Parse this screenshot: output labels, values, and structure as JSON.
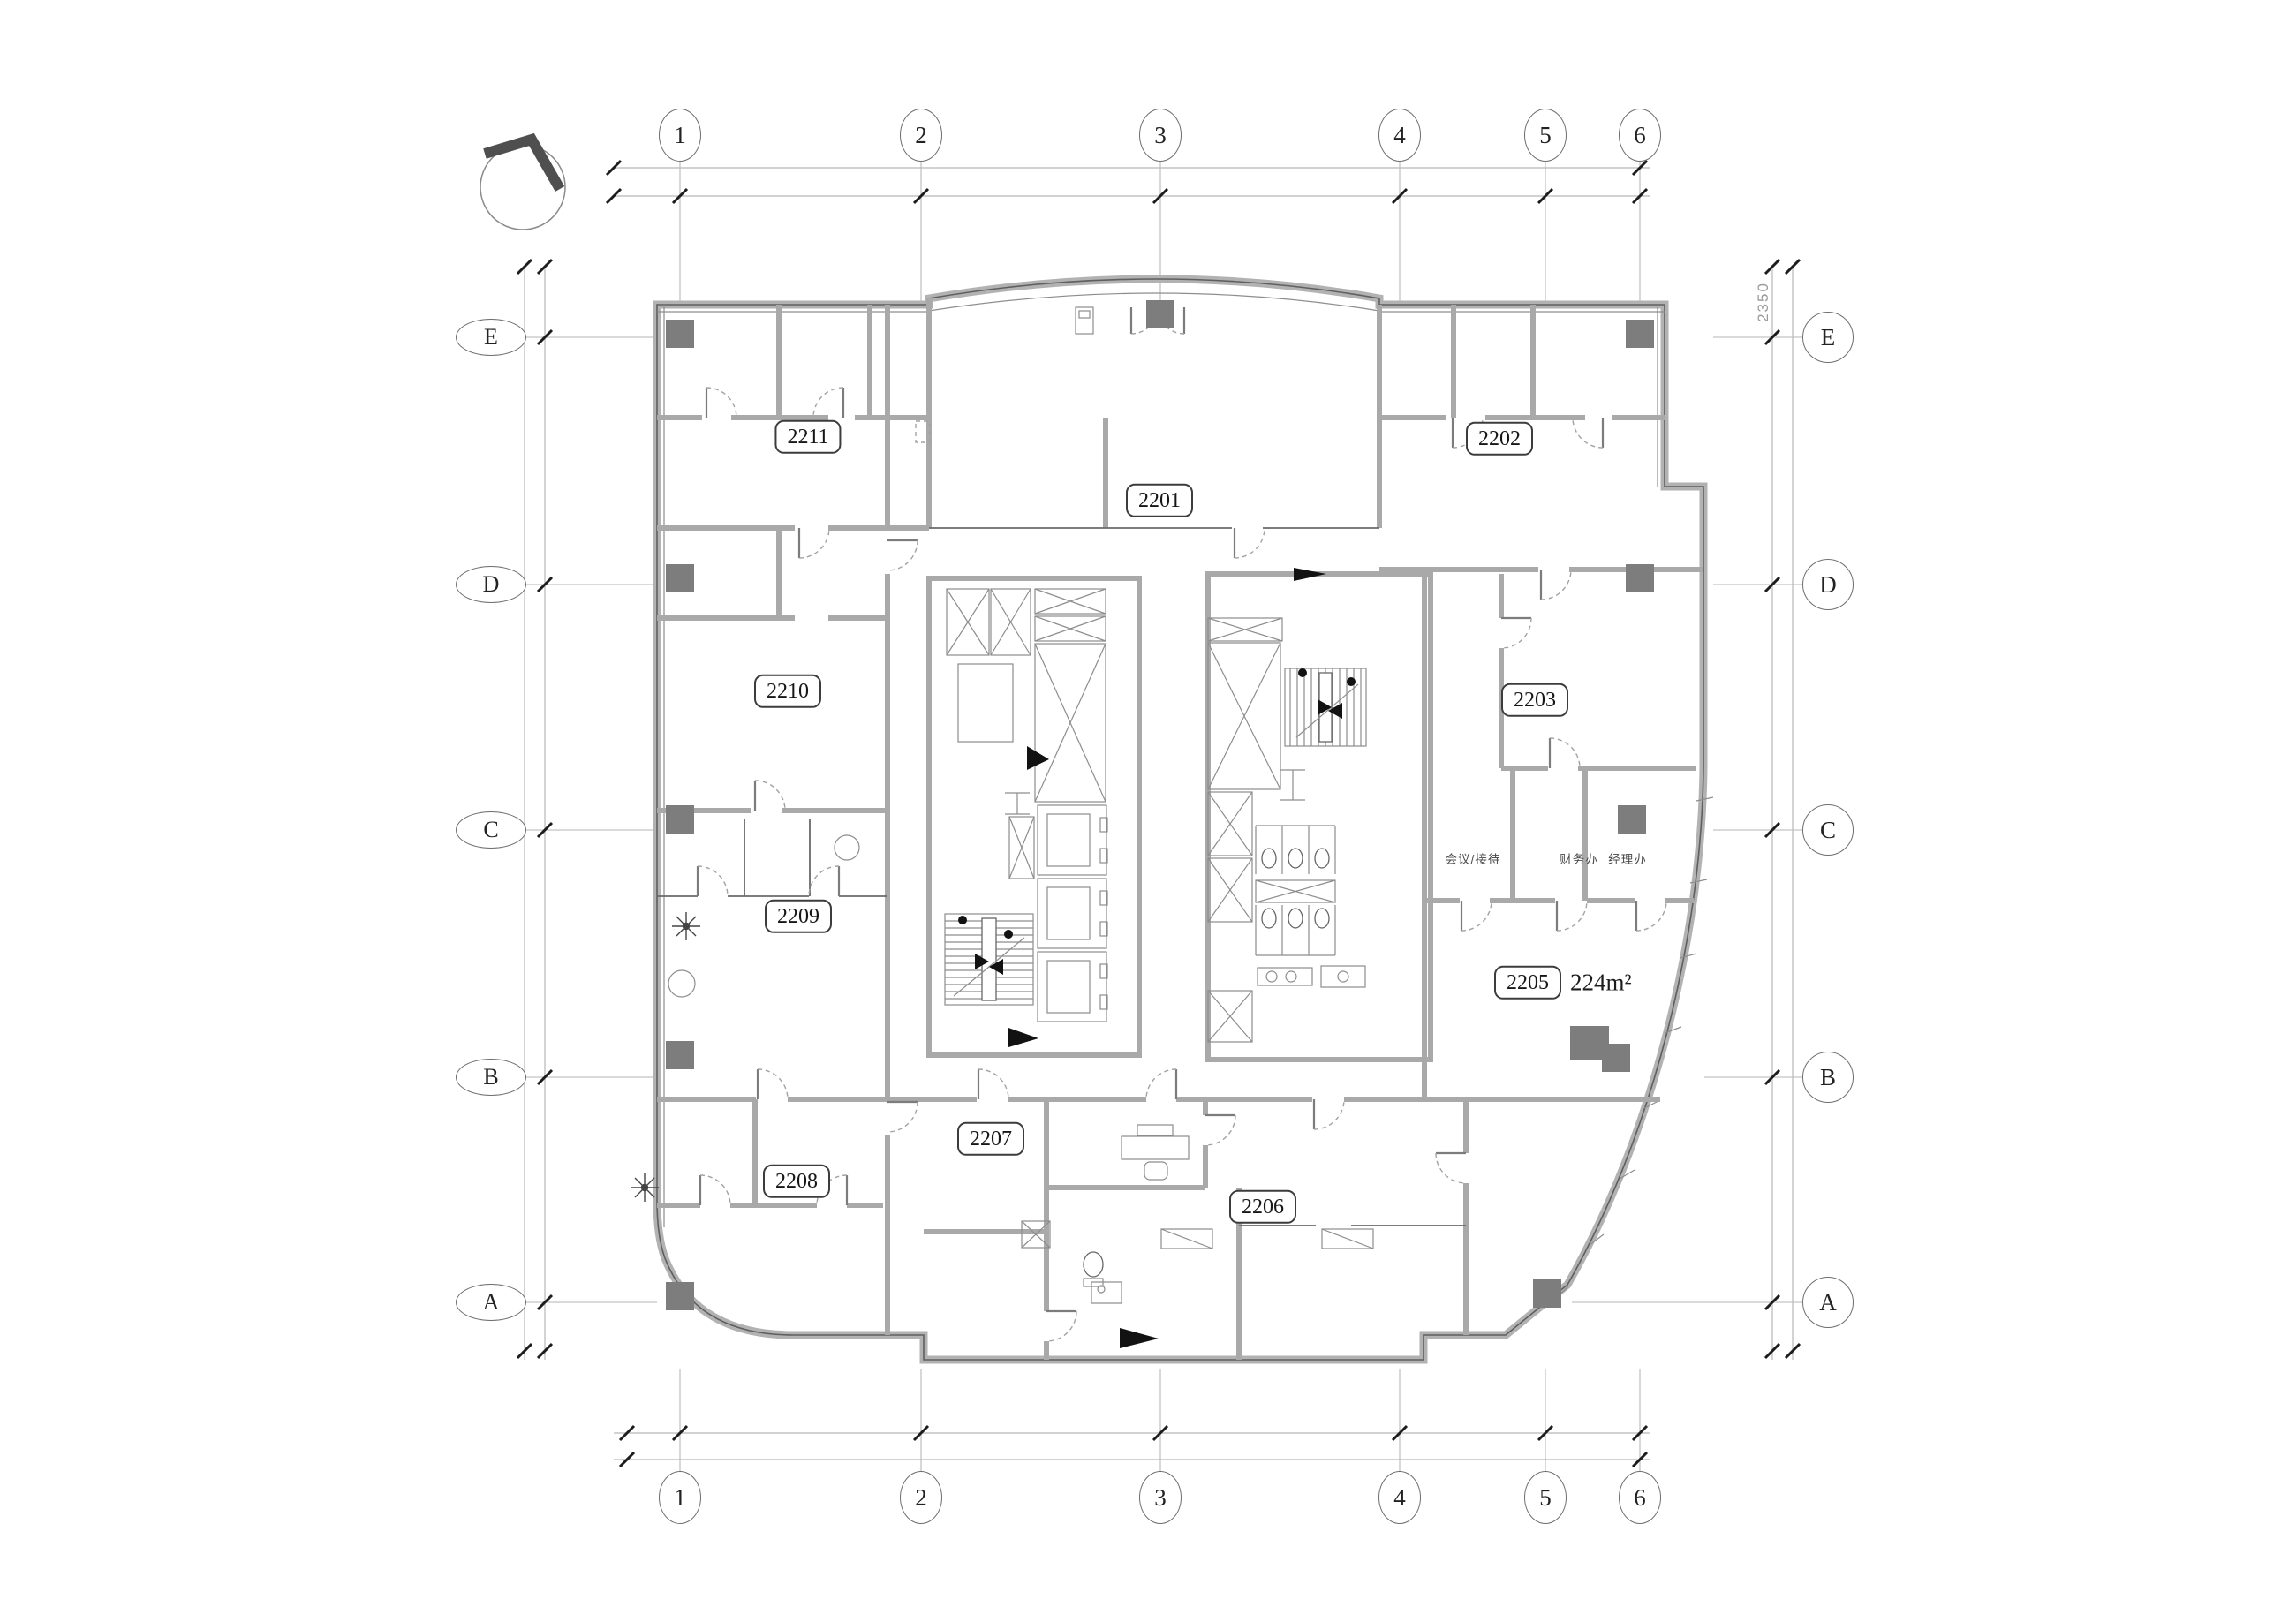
{
  "grid": {
    "columns": [
      "1",
      "2",
      "3",
      "4",
      "5",
      "6"
    ],
    "rows": [
      "E",
      "D",
      "C",
      "B",
      "A"
    ]
  },
  "rooms": [
    {
      "id": "2211"
    },
    {
      "id": "2201"
    },
    {
      "id": "2202"
    },
    {
      "id": "2210"
    },
    {
      "id": "2203"
    },
    {
      "id": "2209"
    },
    {
      "id": "2205",
      "area": "224m²"
    },
    {
      "id": "2207"
    },
    {
      "id": "2208"
    },
    {
      "id": "2206"
    }
  ],
  "offices": [
    "会议/接待",
    "财务办",
    "经理办"
  ],
  "dimensions": {
    "right_vertical": "2350"
  },
  "icons": {
    "north_arrow": "north-arrow"
  },
  "colors": {
    "wall": "#a9a9a9",
    "outer_wall": "#b2b2b2",
    "line": "#5f5f5f",
    "column": "#7d7d7d",
    "grid": "#c4c4c4",
    "text": "#161616",
    "marker": "#121212"
  }
}
